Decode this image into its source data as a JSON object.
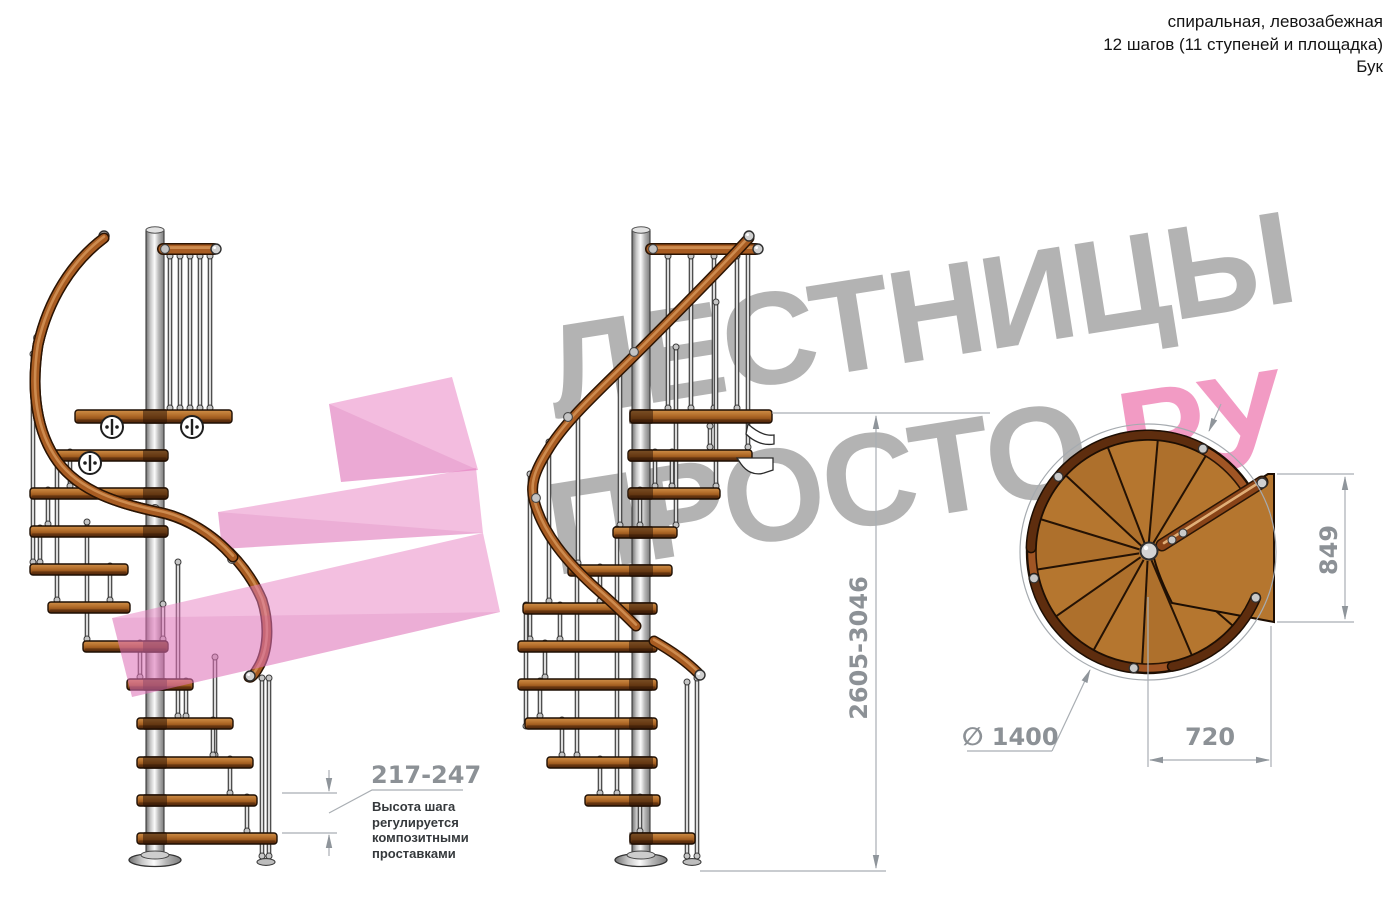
{
  "header": {
    "line1": "спиральная, левозабежная",
    "line2": "12 шагов (11 ступеней и площадка)",
    "line3": "Бук"
  },
  "watermark": {
    "word1": "ЛЕСТНИЦЫ",
    "word2": "ПРОСТО",
    "word2_suffix": ".РУ",
    "gray_color": "#9b9b9b",
    "pink_color": "#ef6ea6"
  },
  "dimensions": {
    "step_height": {
      "value": "217-247",
      "note": "Высота шага\nрегулируется\nкомпозитными\nпроставками"
    },
    "total_height": {
      "value": "2605-3046"
    },
    "landing_depth": {
      "value": "849"
    },
    "diameter": {
      "symbol": "∅",
      "value": "1400"
    },
    "landing_width": {
      "value": "720"
    }
  },
  "colors": {
    "wood": "#a85c22",
    "wood_dark": "#5e2d0e",
    "steel": "#d9d9d9",
    "dimension_text": "#8c9196",
    "watermark_pink": "#ef6ea6"
  }
}
